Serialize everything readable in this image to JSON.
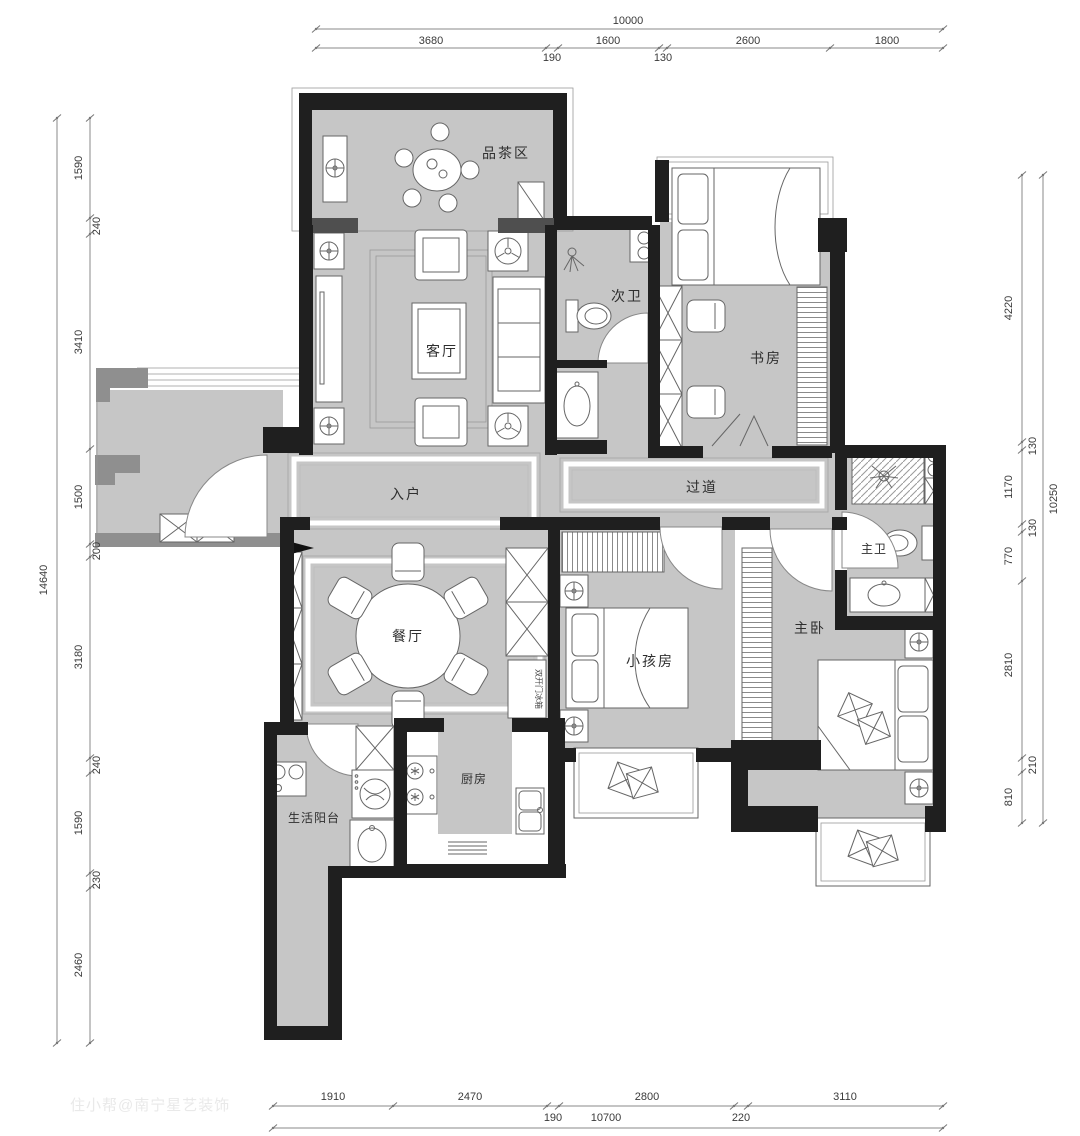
{
  "meta": {
    "watermark": "住小帮@南宁星艺装饰"
  },
  "colors": {
    "wall": "#1f1f1f",
    "floor": "#c6c6c6",
    "dimension_text": "#3a3a3a"
  },
  "rooms": {
    "tea_area": "品茶区",
    "living_room": "客厅",
    "second_bath": "次卫",
    "study": "书房",
    "entry": "入户",
    "hallway": "过道",
    "master_bath": "主卫",
    "dining_room": "餐厅",
    "kids_room": "小孩房",
    "master_bedroom": "主卧",
    "kitchen": "厨房",
    "service_balcony": "生活阳台",
    "fridge_note": "双开门冰箱"
  },
  "dimensions": {
    "top": {
      "total": "10000",
      "segments": [
        "3680",
        "190",
        "1600",
        "130",
        "2600",
        "1800"
      ]
    },
    "left": {
      "total": "14640",
      "segments": [
        "1590",
        "240",
        "3410",
        "1500",
        "200",
        "3180",
        "240",
        "1590",
        "230",
        "2460"
      ]
    },
    "right": {
      "total": "10250",
      "segments": [
        "4220",
        "130",
        "1170",
        "130",
        "770",
        "2810",
        "210",
        "810"
      ]
    },
    "bottom": {
      "total": "10700",
      "segments": [
        "1910",
        "2470",
        "190",
        "2800",
        "220",
        "3110"
      ]
    }
  }
}
